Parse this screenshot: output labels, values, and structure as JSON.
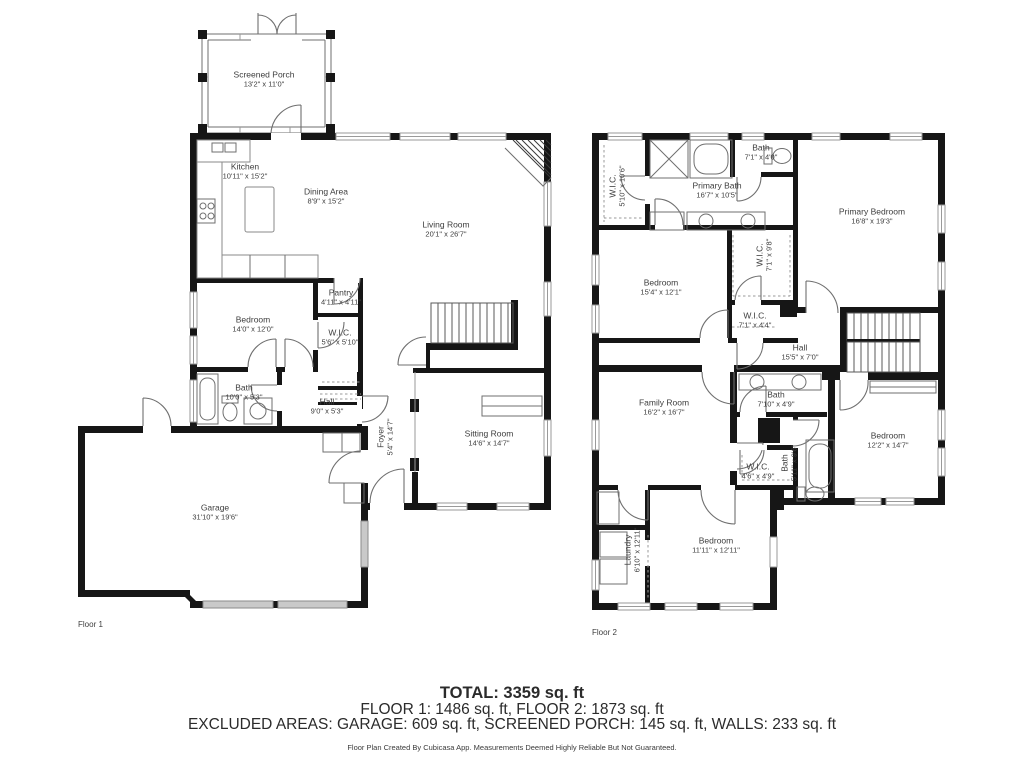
{
  "floor1": {
    "label": "Floor 1",
    "rooms": [
      {
        "name": "Screened Porch",
        "dims": "13'2\" x 11'0\""
      },
      {
        "name": "Kitchen",
        "dims": "10'11\" x 15'2\""
      },
      {
        "name": "Dining Area",
        "dims": "8'9\" x 15'2\""
      },
      {
        "name": "Living Room",
        "dims": "20'1\" x 26'7\""
      },
      {
        "name": "Bedroom",
        "dims": "14'0\" x 12'0\""
      },
      {
        "name": "Pantry",
        "dims": "4'11\" x 4'11\""
      },
      {
        "name": "W.I.C.",
        "dims": "5'6\" x 5'10\""
      },
      {
        "name": "Bath",
        "dims": "10'0\" x 5'3\""
      },
      {
        "name": "Hall",
        "dims": "9'0\" x 5'3\""
      },
      {
        "name": "Foyer",
        "dims": "5'4\" x 14'7\""
      },
      {
        "name": "Sitting Room",
        "dims": "14'6\" x 14'7\""
      },
      {
        "name": "Garage",
        "dims": "31'10\" x 19'6\""
      }
    ]
  },
  "floor2": {
    "label": "Floor 2",
    "rooms": [
      {
        "name": "W.I.C.",
        "dims": "5'10\" x 10'6\""
      },
      {
        "name": "Primary Bath",
        "dims": "16'7\" x 10'5\""
      },
      {
        "name": "Bath",
        "dims": "7'1\" x 4'0\""
      },
      {
        "name": "Primary Bedroom",
        "dims": "16'8\" x 19'3\""
      },
      {
        "name": "Bedroom",
        "dims": "15'4\" x 12'1\""
      },
      {
        "name": "W.I.C.",
        "dims": "7'1\" x 9'8\""
      },
      {
        "name": "W.I.C.",
        "dims": "7'1\" x 4'4\""
      },
      {
        "name": "Hall",
        "dims": "15'5\" x 7'0\""
      },
      {
        "name": "Family Room",
        "dims": "16'2\" x 16'7\""
      },
      {
        "name": "Bath",
        "dims": "7'10\" x 4'9\""
      },
      {
        "name": "Bedroom",
        "dims": "12'2\" x 14'7\""
      },
      {
        "name": "Bath",
        "dims": "5'11\" x 9'6\""
      },
      {
        "name": "W.I.C.",
        "dims": "4'6\" x 4'9\""
      },
      {
        "name": "Laundry",
        "dims": "6'10\" x 12'11\""
      },
      {
        "name": "Bedroom",
        "dims": "11'11\" x 12'11\""
      }
    ]
  },
  "summary": {
    "total": "TOTAL: 3359 sq. ft",
    "floors": "FLOOR 1: 1486 sq. ft, FLOOR 2: 1873 sq. ft",
    "excluded": "EXCLUDED AREAS: GARAGE: 609 sq. ft, SCREENED PORCH: 145 sq. ft, WALLS: 233 sq. ft",
    "disclaimer": "Floor Plan Created By Cubicasa App. Measurements Deemed Highly Reliable But Not Guaranteed."
  }
}
